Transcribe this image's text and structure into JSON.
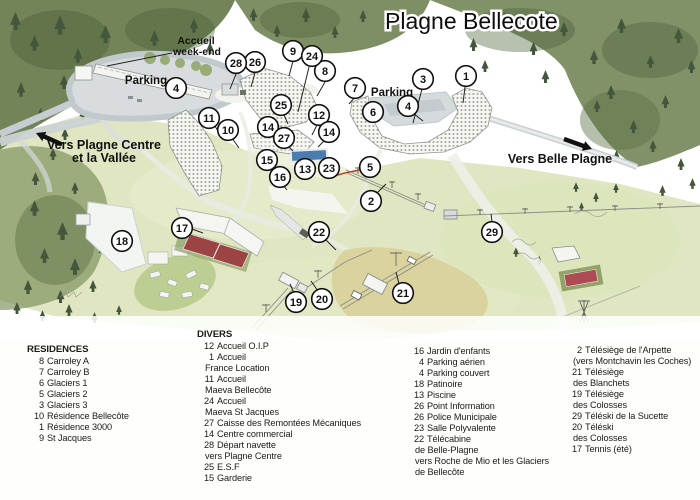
{
  "title": "Plagne Bellecote",
  "map": {
    "labels": {
      "accueil_line1": "Accueil",
      "accueil_line2": "week-end",
      "parking_left": "Parking",
      "parking_right": "Parking",
      "vers_plagne_line1": "Vers Plagne Centre",
      "vers_plagne_line2": "et la Vallée",
      "vers_belle_plagne": "Vers Belle Plagne"
    },
    "markers": [
      {
        "n": "1",
        "x": 466,
        "y": 76
      },
      {
        "n": "2",
        "x": 371,
        "y": 201
      },
      {
        "n": "3",
        "x": 423,
        "y": 79
      },
      {
        "n": "4",
        "x": 176,
        "y": 88
      },
      {
        "n": "4",
        "x": 408,
        "y": 106
      },
      {
        "n": "5",
        "x": 370,
        "y": 167
      },
      {
        "n": "6",
        "x": 373,
        "y": 112
      },
      {
        "n": "7",
        "x": 355,
        "y": 88
      },
      {
        "n": "8",
        "x": 325,
        "y": 71
      },
      {
        "n": "9",
        "x": 293,
        "y": 51
      },
      {
        "n": "10",
        "x": 228,
        "y": 130
      },
      {
        "n": "11",
        "x": 209,
        "y": 118
      },
      {
        "n": "12",
        "x": 319,
        "y": 115
      },
      {
        "n": "13",
        "x": 305,
        "y": 169
      },
      {
        "n": "14",
        "x": 268,
        "y": 127
      },
      {
        "n": "14",
        "x": 329,
        "y": 132
      },
      {
        "n": "15",
        "x": 267,
        "y": 160
      },
      {
        "n": "16",
        "x": 280,
        "y": 177
      },
      {
        "n": "17",
        "x": 182,
        "y": 228
      },
      {
        "n": "18",
        "x": 122,
        "y": 241
      },
      {
        "n": "19",
        "x": 296,
        "y": 302
      },
      {
        "n": "20",
        "x": 322,
        "y": 299
      },
      {
        "n": "21",
        "x": 403,
        "y": 293
      },
      {
        "n": "22",
        "x": 319,
        "y": 232
      },
      {
        "n": "23",
        "x": 329,
        "y": 168
      },
      {
        "n": "24",
        "x": 312,
        "y": 56
      },
      {
        "n": "25",
        "x": 281,
        "y": 105
      },
      {
        "n": "26",
        "x": 255,
        "y": 62
      },
      {
        "n": "27",
        "x": 284,
        "y": 138
      },
      {
        "n": "28",
        "x": 236,
        "y": 63
      },
      {
        "n": "29",
        "x": 492,
        "y": 232
      }
    ],
    "leader_lines": [
      [
        293,
        61,
        289,
        76
      ],
      [
        309,
        67,
        298,
        112
      ],
      [
        236,
        74,
        230,
        89
      ],
      [
        255,
        73,
        251,
        87
      ],
      [
        325,
        82,
        317,
        96
      ],
      [
        422,
        89,
        413,
        123
      ],
      [
        465,
        87,
        463,
        103
      ],
      [
        215,
        126,
        222,
        138
      ],
      [
        232,
        138,
        239,
        148
      ],
      [
        413,
        113,
        423,
        121
      ],
      [
        355,
        97,
        349,
        104
      ],
      [
        284,
        115,
        288,
        124
      ],
      [
        317,
        125,
        312,
        135
      ],
      [
        272,
        135,
        277,
        143
      ],
      [
        325,
        140,
        318,
        147
      ],
      [
        288,
        146,
        293,
        151
      ],
      [
        271,
        167,
        277,
        173
      ],
      [
        283,
        185,
        287,
        190
      ],
      [
        192,
        229,
        203,
        233
      ],
      [
        326,
        240,
        336,
        250
      ],
      [
        492,
        222,
        491,
        214
      ],
      [
        399,
        284,
        396,
        272
      ],
      [
        294,
        293,
        290,
        284
      ],
      [
        318,
        291,
        311,
        281
      ],
      [
        377,
        193,
        386,
        184
      ],
      [
        172,
        53,
        107,
        66
      ]
    ]
  },
  "legend": {
    "residences": {
      "header": "RESIDENCES",
      "items": [
        [
          "8",
          "Carroley A"
        ],
        [
          "7",
          "Carroley B"
        ],
        [
          "6",
          "Glaciers 1"
        ],
        [
          "5",
          "Glaciers 2"
        ],
        [
          "3",
          "Glaciers 3"
        ],
        [
          "10",
          "Résidence Bellecôte"
        ],
        [
          "1",
          "Résidence 3000"
        ],
        [
          "9",
          "St Jacques"
        ]
      ]
    },
    "divers": {
      "header": "DIVERS",
      "items": [
        [
          "12",
          "Accueil O.I.P"
        ],
        [
          "1",
          "Accueil"
        ],
        [
          "",
          "France Location"
        ],
        [
          "11",
          "Accueil"
        ],
        [
          "",
          "Maeva Bellecôte"
        ],
        [
          "24",
          "Accueil"
        ],
        [
          "",
          "Maeva St Jacques"
        ],
        [
          "27",
          "Caisse des Remontées Mécaniques"
        ],
        [
          "14",
          "Centre commercial"
        ],
        [
          "28",
          "Départ navette"
        ],
        [
          "",
          "vers Plagne Centre"
        ],
        [
          "25",
          "E.S.F"
        ],
        [
          "15",
          "Garderie"
        ]
      ]
    },
    "equipments": {
      "items": [
        [
          "16",
          "Jardin d'enfants"
        ],
        [
          "4",
          "Parking aérien"
        ],
        [
          "4",
          "Parking couvert"
        ],
        [
          "18",
          "Patinoire"
        ],
        [
          "13",
          "Piscine"
        ],
        [
          "26",
          "Point Information"
        ],
        [
          "26",
          "Police Municipale"
        ],
        [
          "23",
          "Salle Polyvalente"
        ],
        [
          "22",
          "Télécabine"
        ],
        [
          "",
          "de Belle-Plagne"
        ],
        [
          "",
          "vers Roche de Mio et les Glaciers"
        ],
        [
          "",
          "de Bellecôte"
        ]
      ]
    },
    "lifts": {
      "items": [
        [
          "2",
          "Télésiège de l'Arpette"
        ],
        [
          "",
          "(vers Montchavin les Coches)"
        ],
        [
          "21",
          "Télésiège"
        ],
        [
          "",
          "des Blanchets"
        ],
        [
          "19",
          "Télésiège"
        ],
        [
          "",
          "des Colosses"
        ],
        [
          "29",
          "Téléski de la Sucette"
        ],
        [
          "20",
          "Téléski"
        ],
        [
          "",
          "des Colosses"
        ],
        [
          "17",
          "Tennis (été)"
        ]
      ]
    }
  },
  "colors": {
    "forest_green": "#66794a",
    "meadow_green": "#d7e0b2",
    "road_gray": "#c6cdd1",
    "pool_blue": "#4a7cae",
    "court_red": "#9c4444",
    "slope_tan": "#d9cf97",
    "marker_fill": "#ffffff",
    "marker_border": "#000000"
  }
}
